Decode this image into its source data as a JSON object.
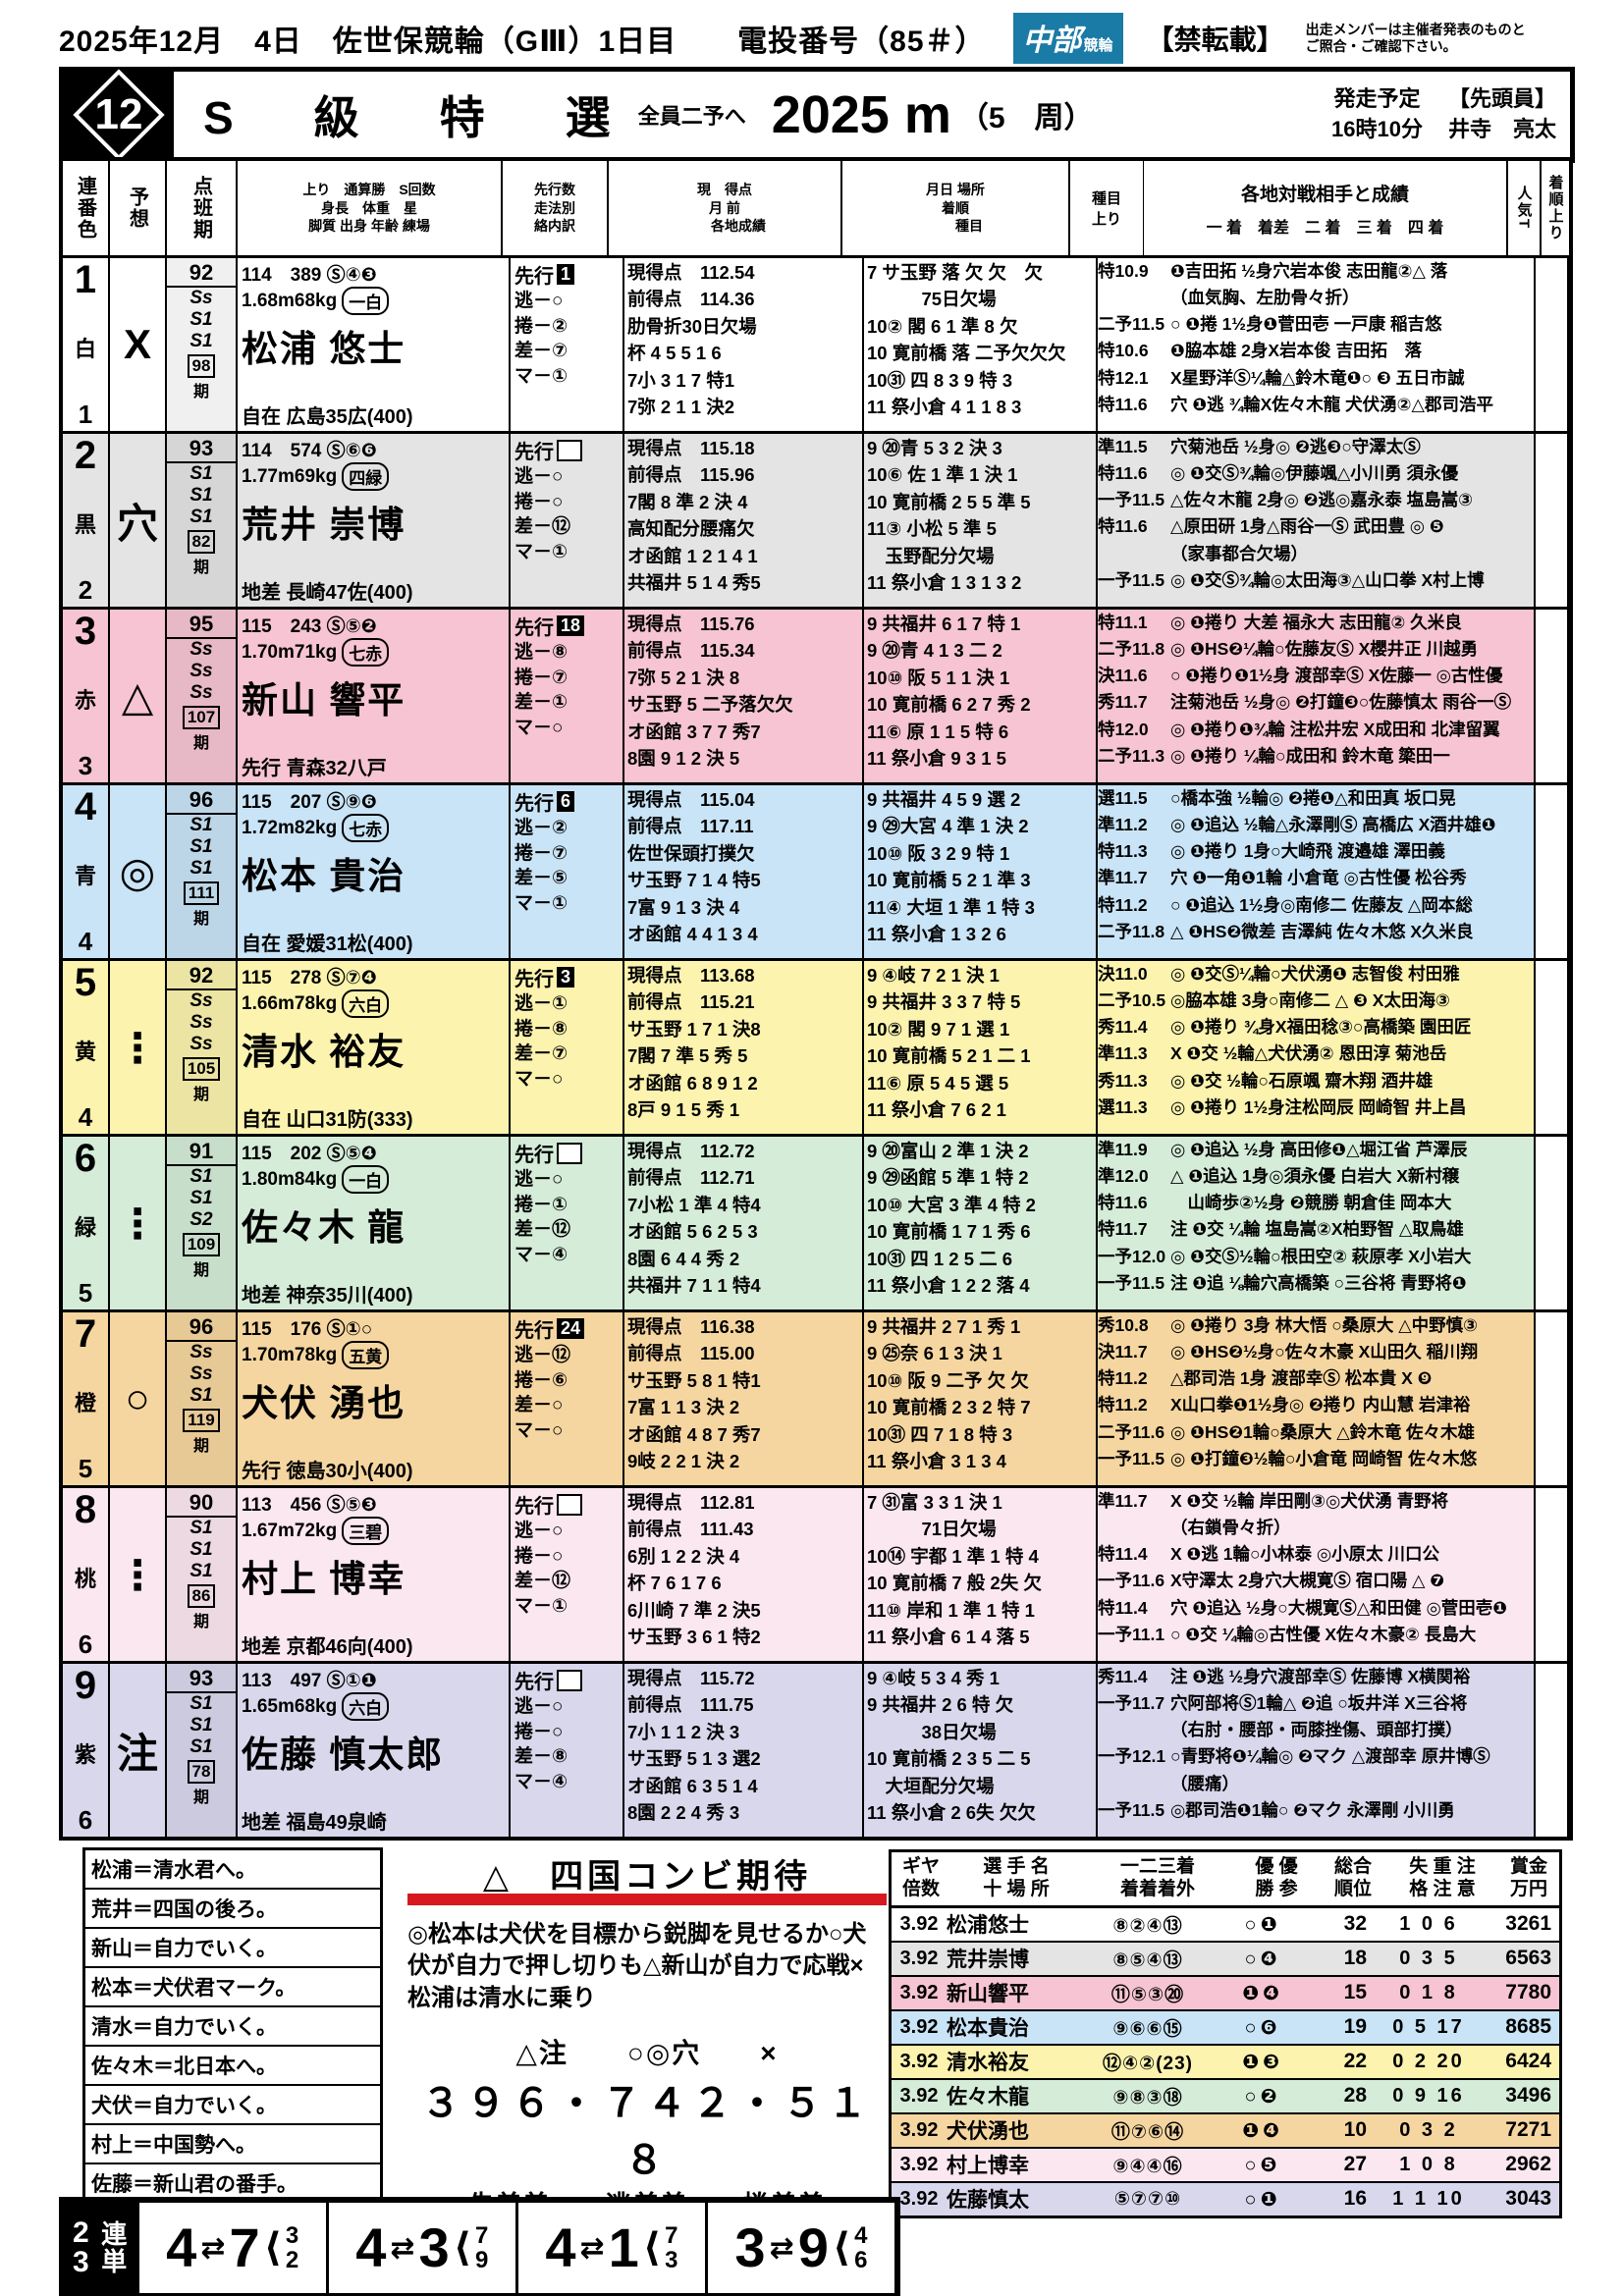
{
  "header": {
    "title_line": "2025年12月　4日　佐世保競輪（GⅢ）1日目　　電投番号（85＃）",
    "logo_main": "中部",
    "logo_sub": "競輪",
    "no_copy": "【禁転載】",
    "notice": "出走メンバーは主催者発表のものと\nご照合・ご確認下さい。"
  },
  "race": {
    "number": "12",
    "title": "S　級　特　選",
    "subtitle": "全員二予へ",
    "distance": "2025 m",
    "laps": "（5　周）",
    "start_label": "発走予定\n16時10分",
    "pacer_label": "【先頭員】\n井寺　亮太"
  },
  "table_header": {
    "c1": "連番色",
    "c2": "予想",
    "c3": "点班期",
    "c4": "上り　通算勝　S回数\n身長　体重　星\n脚質 出身 年齢 練場",
    "c5": "先行数\n走法別\n絡内訳",
    "c6": "現　得点\n月 前\n　　各地成績",
    "c7": "月日 場所\n着順\n　　種目",
    "c8a": "種目",
    "c8b": "上り",
    "c9": "各地対戦相手と成績",
    "c9b": "一 着　着差　二 着　三 着　四 着",
    "c10": "人気T",
    "c11": "着順上り"
  },
  "riders": [
    {
      "num": "1",
      "waku": "1",
      "color": "白",
      "bg": "#ffffff",
      "mark": "X",
      "pts": "92",
      "ranks": [
        "Ss",
        "S1",
        "S1"
      ],
      "term": "98",
      "career": "114　389 Ⓢ④❸",
      "body": "1.68m68kg",
      "star": "一白",
      "name": "松浦 悠士",
      "style": "自在 広島35広(400)",
      "senko": "1",
      "tact": [
        "逃－○",
        "捲－②",
        "差－⑦",
        "マ－①"
      ],
      "scores": [
        "現得点　112.54",
        "前得点　114.36",
        "肋骨折30日欠場",
        "杯 4 5 5 1 6",
        "7小 3 1 7 特1",
        "7弥 2 1 1 決2"
      ],
      "results": [
        "7 サ玉野 落 欠 欠　欠",
        "　　　75日欠場",
        "10② 閣 6 1 準 8 欠",
        "10 寛前橋 落 二予欠欠欠",
        "10㉛ 四 8 3 9 特 3",
        "11 祭小倉 4 1 1 8 3"
      ],
      "opps": [
        {
          "a": "特10.9",
          "t": "❶吉田拓 ½身穴岩本俊 志田龍②△ 落"
        },
        {
          "a": "",
          "t": "（血気胸、左肋骨々折）"
        },
        {
          "a": "二予11.5",
          "t": "○ ❶捲 1½身❶菅田壱 一戸康 稲吉悠"
        },
        {
          "a": "特10.6",
          "t": "❶脇本雄 2身X岩本俊 吉田拓　落"
        },
        {
          "a": "特12.1",
          "t": "X星野洋Ⓢ¼輪△鈴木竜❶○ ❸ 五日市誠"
        },
        {
          "a": "特11.6",
          "t": "穴 ❶逃 ¾輪X佐々木龍 犬伏湧②△郡司浩平"
        }
      ],
      "note": "追加"
    },
    {
      "num": "2",
      "waku": "2",
      "color": "黒",
      "bg": "#e4e4e4",
      "mark": "穴",
      "pts": "93",
      "ranks": [
        "S1",
        "S1",
        "S1"
      ],
      "term": "82",
      "career": "114　574 Ⓢ⑥❻",
      "body": "1.77m69kg",
      "star": "四緑",
      "name": "荒井 崇博",
      "style": "地差 長崎47佐(400)",
      "senko": "",
      "tact": [
        "逃－○",
        "捲－○",
        "差－⑫",
        "マ－①"
      ],
      "scores": [
        "現得点　115.18",
        "前得点　115.96",
        "7閣 8 準 2 決 4",
        "高知配分腰痛欠",
        "オ函館 1 2 1 4 1",
        "共福井 5 1 4 秀5"
      ],
      "results": [
        "9 ⑳青 5 3 2 決 3",
        "10⑥ 佐 1 準 1 決 1",
        "10 寛前橋 2 5 5 準 5",
        "11③ 小松 5 準 5",
        "　玉野配分欠場",
        "11 祭小倉 1 3 1 3 2"
      ],
      "opps": [
        {
          "a": "準11.5",
          "t": "穴菊池岳 ½身◎ ❷逃❸○守澤太Ⓢ"
        },
        {
          "a": "特11.6",
          "t": "◎ ❶交Ⓢ¾輪◎伊藤颯△小川勇 須永優"
        },
        {
          "a": "一予11.5",
          "t": "△佐々木龍 2身◎ ❷逃◎嘉永泰 塩島嵩③"
        },
        {
          "a": "特11.6",
          "t": "△原田研 1身△雨谷一Ⓢ 武田豊 ◎ ❺"
        },
        {
          "a": "",
          "t": "（家事都合欠場）"
        },
        {
          "a": "一予11.5",
          "t": "◎ ❶交Ⓢ¾輪◎太田海③△山口拳 X村上博"
        }
      ],
      "note": ""
    },
    {
      "num": "3",
      "waku": "3",
      "color": "赤",
      "bg": "#f6c4d2",
      "mark": "△",
      "pts": "95",
      "ranks": [
        "Ss",
        "Ss",
        "Ss"
      ],
      "term": "107",
      "career": "115　243 Ⓢ⑤❷",
      "body": "1.70m71kg",
      "star": "七赤",
      "name": "新山 響平",
      "style": "先行 青森32八戸",
      "senko": "18",
      "tact": [
        "逃－⑧",
        "捲－⑦",
        "差－①",
        "マ－○"
      ],
      "scores": [
        "現得点　115.76",
        "前得点　115.34",
        "7弥 5 2 1 決 8",
        "サ玉野 5 二予落欠欠",
        "オ函館 3 7 7 秀7",
        "8園 9 1 2 決 5"
      ],
      "results": [
        "9 共福井 6 1 7 特 1",
        "9 ⑳青 4 1 3 二 2",
        "10⑩ 阪 5 1 1 決 1",
        "10 寛前橋 6 2 7 秀 2",
        "11⑥ 原 1 1 5 特 6",
        "11 祭小倉 9 3 1 5"
      ],
      "opps": [
        {
          "a": "特11.1",
          "t": "◎ ❶捲り 大差 福永大 志田龍② 久米良"
        },
        {
          "a": "二予11.8",
          "t": "◎ ❶HS❷¼輪○佐藤友Ⓢ X櫻井正 川越勇"
        },
        {
          "a": "決11.6",
          "t": "○ ❶捲り❶1½身 渡部幸Ⓢ X佐藤一 ◎古性優"
        },
        {
          "a": "秀11.7",
          "t": "注菊池岳 ½身◎ ❷打鐘❸○佐藤慎太 雨谷一Ⓢ"
        },
        {
          "a": "特12.0",
          "t": "◎ ❶捲り❶¾輪 注松井宏 X成田和 北津留翼"
        },
        {
          "a": "二予11.3",
          "t": "◎ ❶捲り ¼輪○成田和 鈴木竜 簗田一"
        }
      ],
      "note": ""
    },
    {
      "num": "4",
      "waku": "4",
      "color": "青",
      "bg": "#c9e4f6",
      "mark": "◎",
      "pts": "96",
      "ranks": [
        "S1",
        "S1",
        "S1"
      ],
      "term": "111",
      "career": "115　207 Ⓢ⑨❻",
      "body": "1.72m82kg",
      "star": "七赤",
      "name": "松本 貴治",
      "style": "自在 愛媛31松(400)",
      "senko": "6",
      "tact": [
        "逃－②",
        "捲－⑦",
        "差－⑤",
        "マ－①"
      ],
      "scores": [
        "現得点　115.04",
        "前得点　117.11",
        "佐世保頭打撲欠",
        "サ玉野 7 1 4 特5",
        "7富 9 1 3 決 4",
        "オ函館 4 4 1 3 4"
      ],
      "results": [
        "9 共福井 4 5 9 選 2",
        "9 ㉙大宮 4 準 1 決 2",
        "10⑩ 阪 3 2 9 特 1",
        "10 寛前橋 5 2 1 準 3",
        "11④ 大垣 1 準 1 特 3",
        "11 祭小倉 1 3 2 6"
      ],
      "opps": [
        {
          "a": "選11.5",
          "t": "○橋本強 ½輪◎ ❷捲❶△和田真 坂口晃"
        },
        {
          "a": "準11.2",
          "t": "◎ ❶追込 ½輪△永澤剛Ⓢ 高橋広 X酒井雄❶"
        },
        {
          "a": "特11.3",
          "t": "◎ ❶捲り 1身○大崎飛 渡邉雄 澤田義"
        },
        {
          "a": "準11.7",
          "t": "穴 ❶一角❶1輪 小倉竜 ◎古性優 松谷秀"
        },
        {
          "a": "特11.2",
          "t": "○ ❶追込 1½身◎南修二 佐藤友 △岡本総"
        },
        {
          "a": "二予11.8",
          "t": "△ ❶HS❷微差 吉澤純 佐々木悠 X久米良"
        }
      ],
      "note": ""
    },
    {
      "num": "5",
      "waku": "4",
      "color": "黄",
      "bg": "#fbf3ae",
      "mark": "⋮",
      "pts": "92",
      "ranks": [
        "Ss",
        "Ss",
        "Ss"
      ],
      "term": "105",
      "career": "115　278 Ⓢ⑦❹",
      "body": "1.66m78kg",
      "star": "六白",
      "name": "清水 裕友",
      "style": "自在 山口31防(333)",
      "senko": "3",
      "tact": [
        "逃－①",
        "捲－⑧",
        "差－⑦",
        "マ－○"
      ],
      "scores": [
        "現得点　113.68",
        "前得点　115.21",
        "サ玉野 1 7 1 決8",
        "7閣 7 準 5 秀 5",
        "オ函館 6 8 9 1 2",
        "8戸 9 1 5 秀 1"
      ],
      "results": [
        "9 ④岐 7 2 1 決 1",
        "9 共福井 3 3 7 特 5",
        "10② 閣 9 7 1 選 1",
        "10 寛前橋 5 2 1 二 1",
        "11⑥ 原 5 4 5 選 5",
        "11 祭小倉 7 6 2 1"
      ],
      "opps": [
        {
          "a": "決11.0",
          "t": "◎ ❶交Ⓢ¼輪○犬伏湧❶ 志智俊 村田雅"
        },
        {
          "a": "二予10.5",
          "t": "◎脇本雄 3身○南修二 △ ❸ X太田海③"
        },
        {
          "a": "秀11.4",
          "t": "◎ ❶捲り ¾身X福田稔③○高橋築 園田匠"
        },
        {
          "a": "準11.3",
          "t": "X ❶交 ½輪△犬伏湧② 恩田淳 菊池岳"
        },
        {
          "a": "秀11.3",
          "t": "◎ ❶交 ½輪○石原颯 齋木翔 酒井雄"
        },
        {
          "a": "選11.3",
          "t": "◎ ❶捲り 1½身注松岡辰 岡崎智 井上昌"
        }
      ],
      "note": ""
    },
    {
      "num": "6",
      "waku": "5",
      "color": "緑",
      "bg": "#d4ecd8",
      "mark": "⋮",
      "pts": "91",
      "ranks": [
        "S1",
        "S1",
        "S2"
      ],
      "term": "109",
      "career": "115　202 Ⓢ⑤❹",
      "body": "1.80m84kg",
      "star": "一白",
      "name": "佐々木 龍",
      "style": "地差 神奈35川(400)",
      "senko": "",
      "tact": [
        "逃－○",
        "捲－①",
        "差－⑫",
        "マ－④"
      ],
      "scores": [
        "現得点　112.72",
        "前得点　112.71",
        "7小松 1 準 4 特4",
        "オ函館 5 6 2 5 3",
        "8園 6 4 4 秀 2",
        "共福井 7 1 1 特4"
      ],
      "results": [
        "9 ⑳富山 2 準 1 決 2",
        "9 ㉙函館 5 準 1 特 2",
        "10⑩ 大宮 3 準 4 特 2",
        "10 寛前橋 1 7 1 秀 6",
        "10㉛ 四 1 2 5 二 6",
        "11 祭小倉 1 2 2 落 4"
      ],
      "opps": [
        {
          "a": "準11.9",
          "t": "◎ ❶追込 ½身 高田修❶△堀江省 芦澤辰"
        },
        {
          "a": "準12.0",
          "t": "△ ❶追込 1身◎須永優 白岩大 X新村穣"
        },
        {
          "a": "特11.6",
          "t": "　山崎歩②½身 ❷競勝 朝倉佳 岡本大"
        },
        {
          "a": "特11.7",
          "t": "注 ❶交 ¼輪 塩島嵩②X柏野智 △取鳥雄"
        },
        {
          "a": "一予12.0",
          "t": "◎ ❶交Ⓢ½輪○根田空② 萩原孝 X小岩大"
        },
        {
          "a": "一予11.5",
          "t": "注 ❶追 ⅛輪穴高橋築 ○三谷将 青野将❶"
        }
      ],
      "note": ""
    },
    {
      "num": "7",
      "waku": "5",
      "color": "橙",
      "bg": "#f6d6a0",
      "mark": "○",
      "pts": "96",
      "ranks": [
        "Ss",
        "Ss",
        "S1"
      ],
      "term": "119",
      "career": "115　176 Ⓢ①○",
      "body": "1.70m78kg",
      "star": "五黄",
      "name": "犬伏 湧也",
      "style": "先行 徳島30小(400)",
      "senko": "24",
      "tact": [
        "逃－⑫",
        "捲－⑥",
        "差－○",
        "マ－○"
      ],
      "scores": [
        "現得点　116.38",
        "前得点　115.00",
        "サ玉野 5 8 1 特1",
        "7富 1 1 3 決 2",
        "オ函館 4 8 7 秀7",
        "9岐 2 2 1 決 2"
      ],
      "results": [
        "9 共福井 2 7 1 秀 1",
        "9 ㉕奈 6 1 3 決 1",
        "10⑩ 阪 9 二予 欠 欠",
        "10 寛前橋 2 3 2 特 7",
        "10㉛ 四 7 1 8 特 3",
        "11 祭小倉 3 1 3 4"
      ],
      "opps": [
        {
          "a": "秀10.8",
          "t": "◎ ❶捲り 3身 林大悟 ○桑原大 △中野慎③"
        },
        {
          "a": "決11.7",
          "t": "◎ ❶HS❷½身○佐々木豪 X山田久 稲川翔"
        },
        {
          "a": "特11.2",
          "t": "△郡司浩 1身 渡部幸Ⓢ 松本貴 X ❾"
        },
        {
          "a": "特11.2",
          "t": "X山口拳❶1½身◎ ❷捲り 内山慧 岩津裕"
        },
        {
          "a": "二予11.6",
          "t": "◎ ❶HS❷1輪○桑原大 △鈴木竜 佐々木雄"
        },
        {
          "a": "一予11.5",
          "t": "◎ ❶打鐘❸½輪○小倉竜 岡崎智 佐々木悠"
        }
      ],
      "note": ""
    },
    {
      "num": "8",
      "waku": "6",
      "color": "桃",
      "bg": "#fbe7f0",
      "mark": "⋮",
      "pts": "90",
      "ranks": [
        "S1",
        "S1",
        "S1"
      ],
      "term": "86",
      "career": "113　456 Ⓢ⑤❸",
      "body": "1.67m72kg",
      "star": "三碧",
      "name": "村上 博幸",
      "style": "地差 京都46向(400)",
      "senko": "",
      "tact": [
        "逃－○",
        "捲－○",
        "差－⑫",
        "マ－①"
      ],
      "scores": [
        "現得点　112.81",
        "前得点　111.43",
        "6別 1 2 2 決 4",
        "杯 7 6 1 7 6",
        "6川崎 7 準 2 決5",
        "サ玉野 3 6 1 特2"
      ],
      "results": [
        "7 ㉛富 3 3 1 決 1",
        "　　　71日欠場",
        "10⑭ 宇都 1 準 1 特 4",
        "10 寛前橋 7 般 2失 欠",
        "11⑩ 岸和 1 準 1 特 1",
        "11 祭小倉 6 1 4 落 5"
      ],
      "opps": [
        {
          "a": "準11.7",
          "t": "X ❶交 ½輪 岸田剛③◎犬伏湧 青野将"
        },
        {
          "a": "",
          "t": "（右鎖骨々折）"
        },
        {
          "a": "特11.4",
          "t": "X ❶逃 1輪○小林泰 ◎小原太 川口公"
        },
        {
          "a": "一予11.6",
          "t": "X守澤太 2身穴大槻寛Ⓢ 宿口陽 △ ❼"
        },
        {
          "a": "特11.4",
          "t": "穴 ❶追込 ½身○大槻寛Ⓢ△和田健 ◎菅田壱❶"
        },
        {
          "a": "一予11.1",
          "t": "○ ❶交 ¼輪◎古性優 X佐々木豪② 長島大"
        }
      ],
      "note": ""
    },
    {
      "num": "9",
      "waku": "6",
      "color": "紫",
      "bg": "#d9d7ec",
      "mark": "注",
      "pts": "93",
      "ranks": [
        "S1",
        "S1",
        "S1"
      ],
      "term": "78",
      "career": "113　497 Ⓢ①❶",
      "body": "1.65m68kg",
      "star": "六白",
      "name": "佐藤 慎太郎",
      "style": "地差 福島49泉崎",
      "senko": "",
      "tact": [
        "逃－○",
        "捲－○",
        "差－⑧",
        "マ－④"
      ],
      "scores": [
        "現得点　115.72",
        "前得点　111.75",
        "7小 1 1 2 決 3",
        "サ玉野 5 1 3 選2",
        "オ函館 6 3 5 1 4",
        "8園 2 2 4 秀 3"
      ],
      "results": [
        "9 ④岐 5 3 4 秀 1",
        "9 共福井 2 6 特 欠",
        "　　　38日欠場",
        "10 寛前橋 2 3 5 二 5",
        "　大垣配分欠場",
        "11 祭小倉 2 6失 欠欠"
      ],
      "opps": [
        {
          "a": "秀11.4",
          "t": "注 ❶逃 ½身穴渡部幸Ⓢ 佐藤博 X横関裕"
        },
        {
          "a": "一予11.7",
          "t": "穴阿部将Ⓢ1輪△ ❷追 ○坂井洋 X三谷将"
        },
        {
          "a": "",
          "t": "（右肘・腰部・両膝挫傷、頭部打撲）"
        },
        {
          "a": "一予12.1",
          "t": "○青野将❶¼輪◎ ❷マク △渡部幸 原井博Ⓢ"
        },
        {
          "a": "",
          "t": "（腰痛）"
        },
        {
          "a": "一予11.5",
          "t": "◎郡司浩❶1輪○ ❷マク 永澤剛 小川勇"
        }
      ],
      "note": ""
    }
  ],
  "comments": [
    "松浦＝清水君へ。",
    "荒井＝四国の後ろ。",
    "新山＝自力でいく。",
    "松本＝犬伏君マーク。",
    "清水＝自力でいく。",
    "佐々木＝北日本へ。",
    "犬伏＝自力でいく。",
    "村上＝中国勢へ。",
    "佐藤＝新山君の番手。"
  ],
  "prediction": {
    "title": "△　四国コンビ期待",
    "body": "◎松本は犬伏を目標から鋭脚を見せるか○犬伏が自力で押し切りも△新山が自力で応戦×松浦は清水に乗り",
    "marks_line": "△注　　○◎穴　　×",
    "numbers_line": "３９６・７４２・５１８",
    "kimarite_line": "先差差　　逃差差　　捲差差",
    "accent_color": "#d7181f"
  },
  "standings": {
    "headers": [
      "ギヤ\n倍数",
      "選 手 名\n十 場 所",
      "一二三着\n着着着外",
      "優 優\n勝 参",
      "総合\n順位",
      "失 重 注\n格 注 意",
      "賞金\n万円"
    ],
    "rows": [
      {
        "gear": "3.92",
        "name": "松浦悠士",
        "rec": "⑧②④⑬",
        "win": "○❶",
        "ord": "32",
        "pen": "1 0 6",
        "prize": "3261",
        "bg": "#ffffff"
      },
      {
        "gear": "3.92",
        "name": "荒井崇博",
        "rec": "⑧⑤④⑬",
        "win": "○❹",
        "ord": "18",
        "pen": "0 3 5",
        "prize": "6563",
        "bg": "#e4e4e4"
      },
      {
        "gear": "3.92",
        "name": "新山響平",
        "rec": "⑪⑤③⑳",
        "win": "❶❹",
        "ord": "15",
        "pen": "0 1 8",
        "prize": "7780",
        "bg": "#f6c4d2"
      },
      {
        "gear": "3.92",
        "name": "松本貴治",
        "rec": "⑨⑥⑥⑮",
        "win": "○❻",
        "ord": "19",
        "pen": "0 5 17",
        "prize": "8685",
        "bg": "#c9e4f6"
      },
      {
        "gear": "3.92",
        "name": "清水裕友",
        "rec": "⑫④②(23)",
        "win": "❶❸",
        "ord": "22",
        "pen": "0 2 20",
        "prize": "6424",
        "bg": "#fbf3ae"
      },
      {
        "gear": "3.92",
        "name": "佐々木龍",
        "rec": "⑨⑧③⑱",
        "win": "○❷",
        "ord": "28",
        "pen": "0 9 16",
        "prize": "3496",
        "bg": "#d4ecd8"
      },
      {
        "gear": "3.92",
        "name": "犬伏湧也",
        "rec": "⑪⑦⑥⑭",
        "win": "❶❹",
        "ord": "10",
        "pen": "0 3 2",
        "prize": "7271",
        "bg": "#f6d6a0"
      },
      {
        "gear": "3.92",
        "name": "村上博幸",
        "rec": "⑨④④⑯",
        "win": "○❺",
        "ord": "27",
        "pen": "1 0 8",
        "prize": "2962",
        "bg": "#fbe7f0"
      },
      {
        "gear": "3.92",
        "name": "佐藤慎太",
        "rec": "⑤⑦⑦⑩",
        "win": "○❶",
        "ord": "16",
        "pen": "1 1 10",
        "prize": "3043",
        "bg": "#d9d7ec"
      }
    ]
  },
  "rentan": {
    "label_nums": [
      "2",
      "3"
    ],
    "label_text": "連単",
    "groups": [
      {
        "a": "4",
        "b": "7",
        "s1": "3",
        "s2": "2"
      },
      {
        "a": "4",
        "b": "3",
        "s1": "7",
        "s2": "9"
      },
      {
        "a": "4",
        "b": "1",
        "s1": "7",
        "s2": "3"
      },
      {
        "a": "3",
        "b": "9",
        "s1": "4",
        "s2": "6"
      }
    ]
  }
}
